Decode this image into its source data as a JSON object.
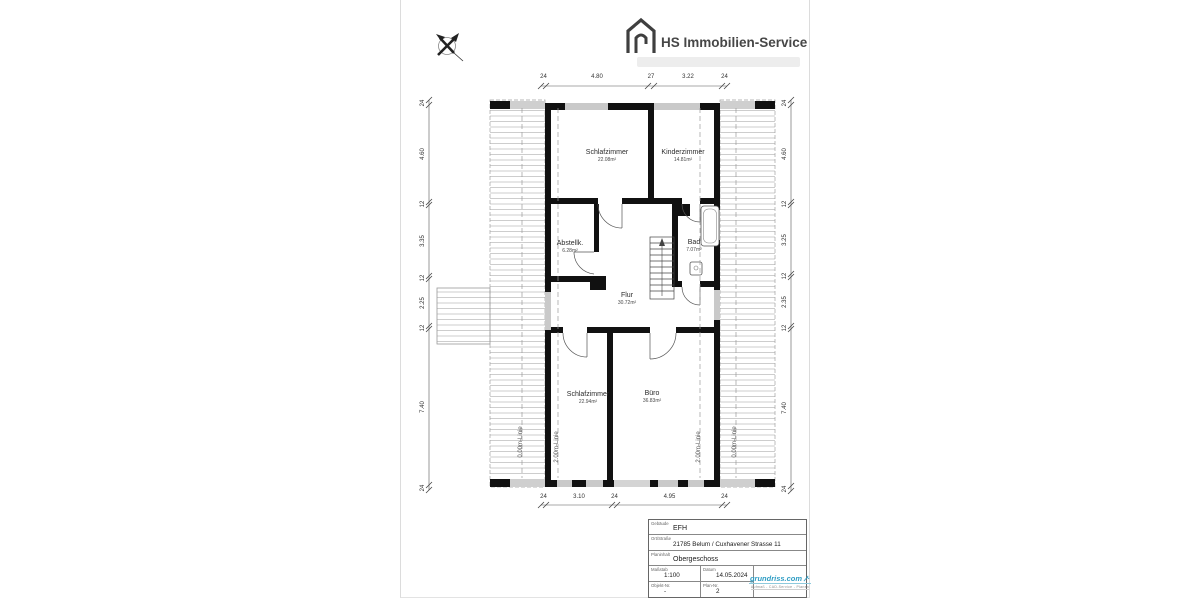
{
  "header": {
    "brand": "HS Immobilien-Service"
  },
  "plan": {
    "rooms": [
      {
        "name": "Schlafzimmer",
        "area": "22.08m²"
      },
      {
        "name": "Kinderzimmer",
        "area": "14.81m²"
      },
      {
        "name": "Abstellk.",
        "area": "6.28m²"
      },
      {
        "name": "Bad",
        "area": "7.07m²"
      },
      {
        "name": "Flur",
        "area": "30.72m²"
      },
      {
        "name": "Schlafzimmer",
        "area": "22.94m²"
      },
      {
        "name": "Büro",
        "area": "36.83m²"
      }
    ],
    "height_lines": [
      "0.00m-Linie",
      "2.00m-Linie",
      "2.00m-Linie",
      "0.00m-Linie"
    ],
    "dimensions": {
      "top": [
        "24",
        "4.80",
        "27",
        "3.22",
        "24"
      ],
      "bottom": [
        "24",
        "3.10",
        "24",
        "4.95",
        "24"
      ],
      "left": [
        "24",
        "4.60",
        "12",
        "3.35",
        "12",
        "2.25",
        "12",
        "7.40",
        "24"
      ],
      "right": [
        "24",
        "4.60",
        "12",
        "3.25",
        "12",
        "2.35",
        "12",
        "7.40",
        "24"
      ]
    }
  },
  "title_block": {
    "gebaeude_label": "Gebäude",
    "gebaeude": "EFH",
    "ort_label": "Ort/Straße",
    "ort": "21785 Belum / Cuxhavener Strasse 11",
    "planinhalt_label": "Planinhalt",
    "planinhalt": "Obergeschoss",
    "massstab_label": "Maßstab",
    "massstab": "1:100",
    "datum_label": "Datum",
    "datum": "14.05.2024",
    "objekt_label": "Objekt-Nr.",
    "objekt": "-",
    "plan_label": "Plan-Nr.",
    "plan": "2",
    "logo_text": "grundriss.com",
    "logo_tagline": "Aufmaß - CAD-Service - Planen"
  }
}
